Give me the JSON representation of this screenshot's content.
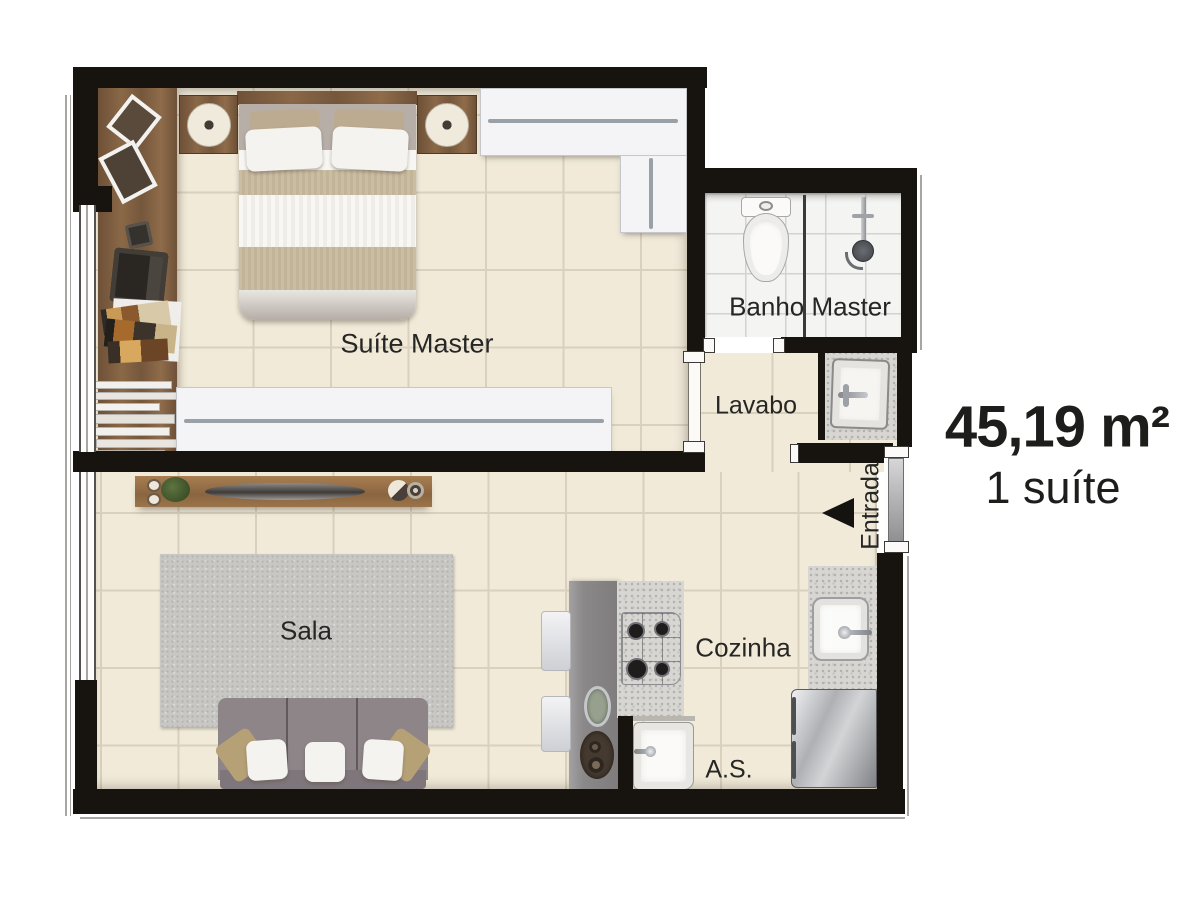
{
  "plan": {
    "rooms": {
      "suite": "Suíte Master",
      "banho": "Banho Master",
      "lavabo": "Lavabo",
      "entrada": "Entrada",
      "sala": "Sala",
      "cozinha": "Cozinha",
      "servico": "A.S."
    },
    "summary": {
      "area": "45,19 m²",
      "suites": "1 suíte"
    },
    "colors": {
      "wall": "#17130e",
      "floor": "#f1ead9",
      "grout": "#d9d0bd",
      "bath_tile": "#f4f4f2",
      "wood_dark": "#6f523a",
      "wood_desk": "#7d5e41",
      "wood_sideboard": "#9b744a",
      "sofa": "#8e8589",
      "rug": "#c9c7c4",
      "island": "#8b8889",
      "accent_text": "#262624"
    }
  }
}
